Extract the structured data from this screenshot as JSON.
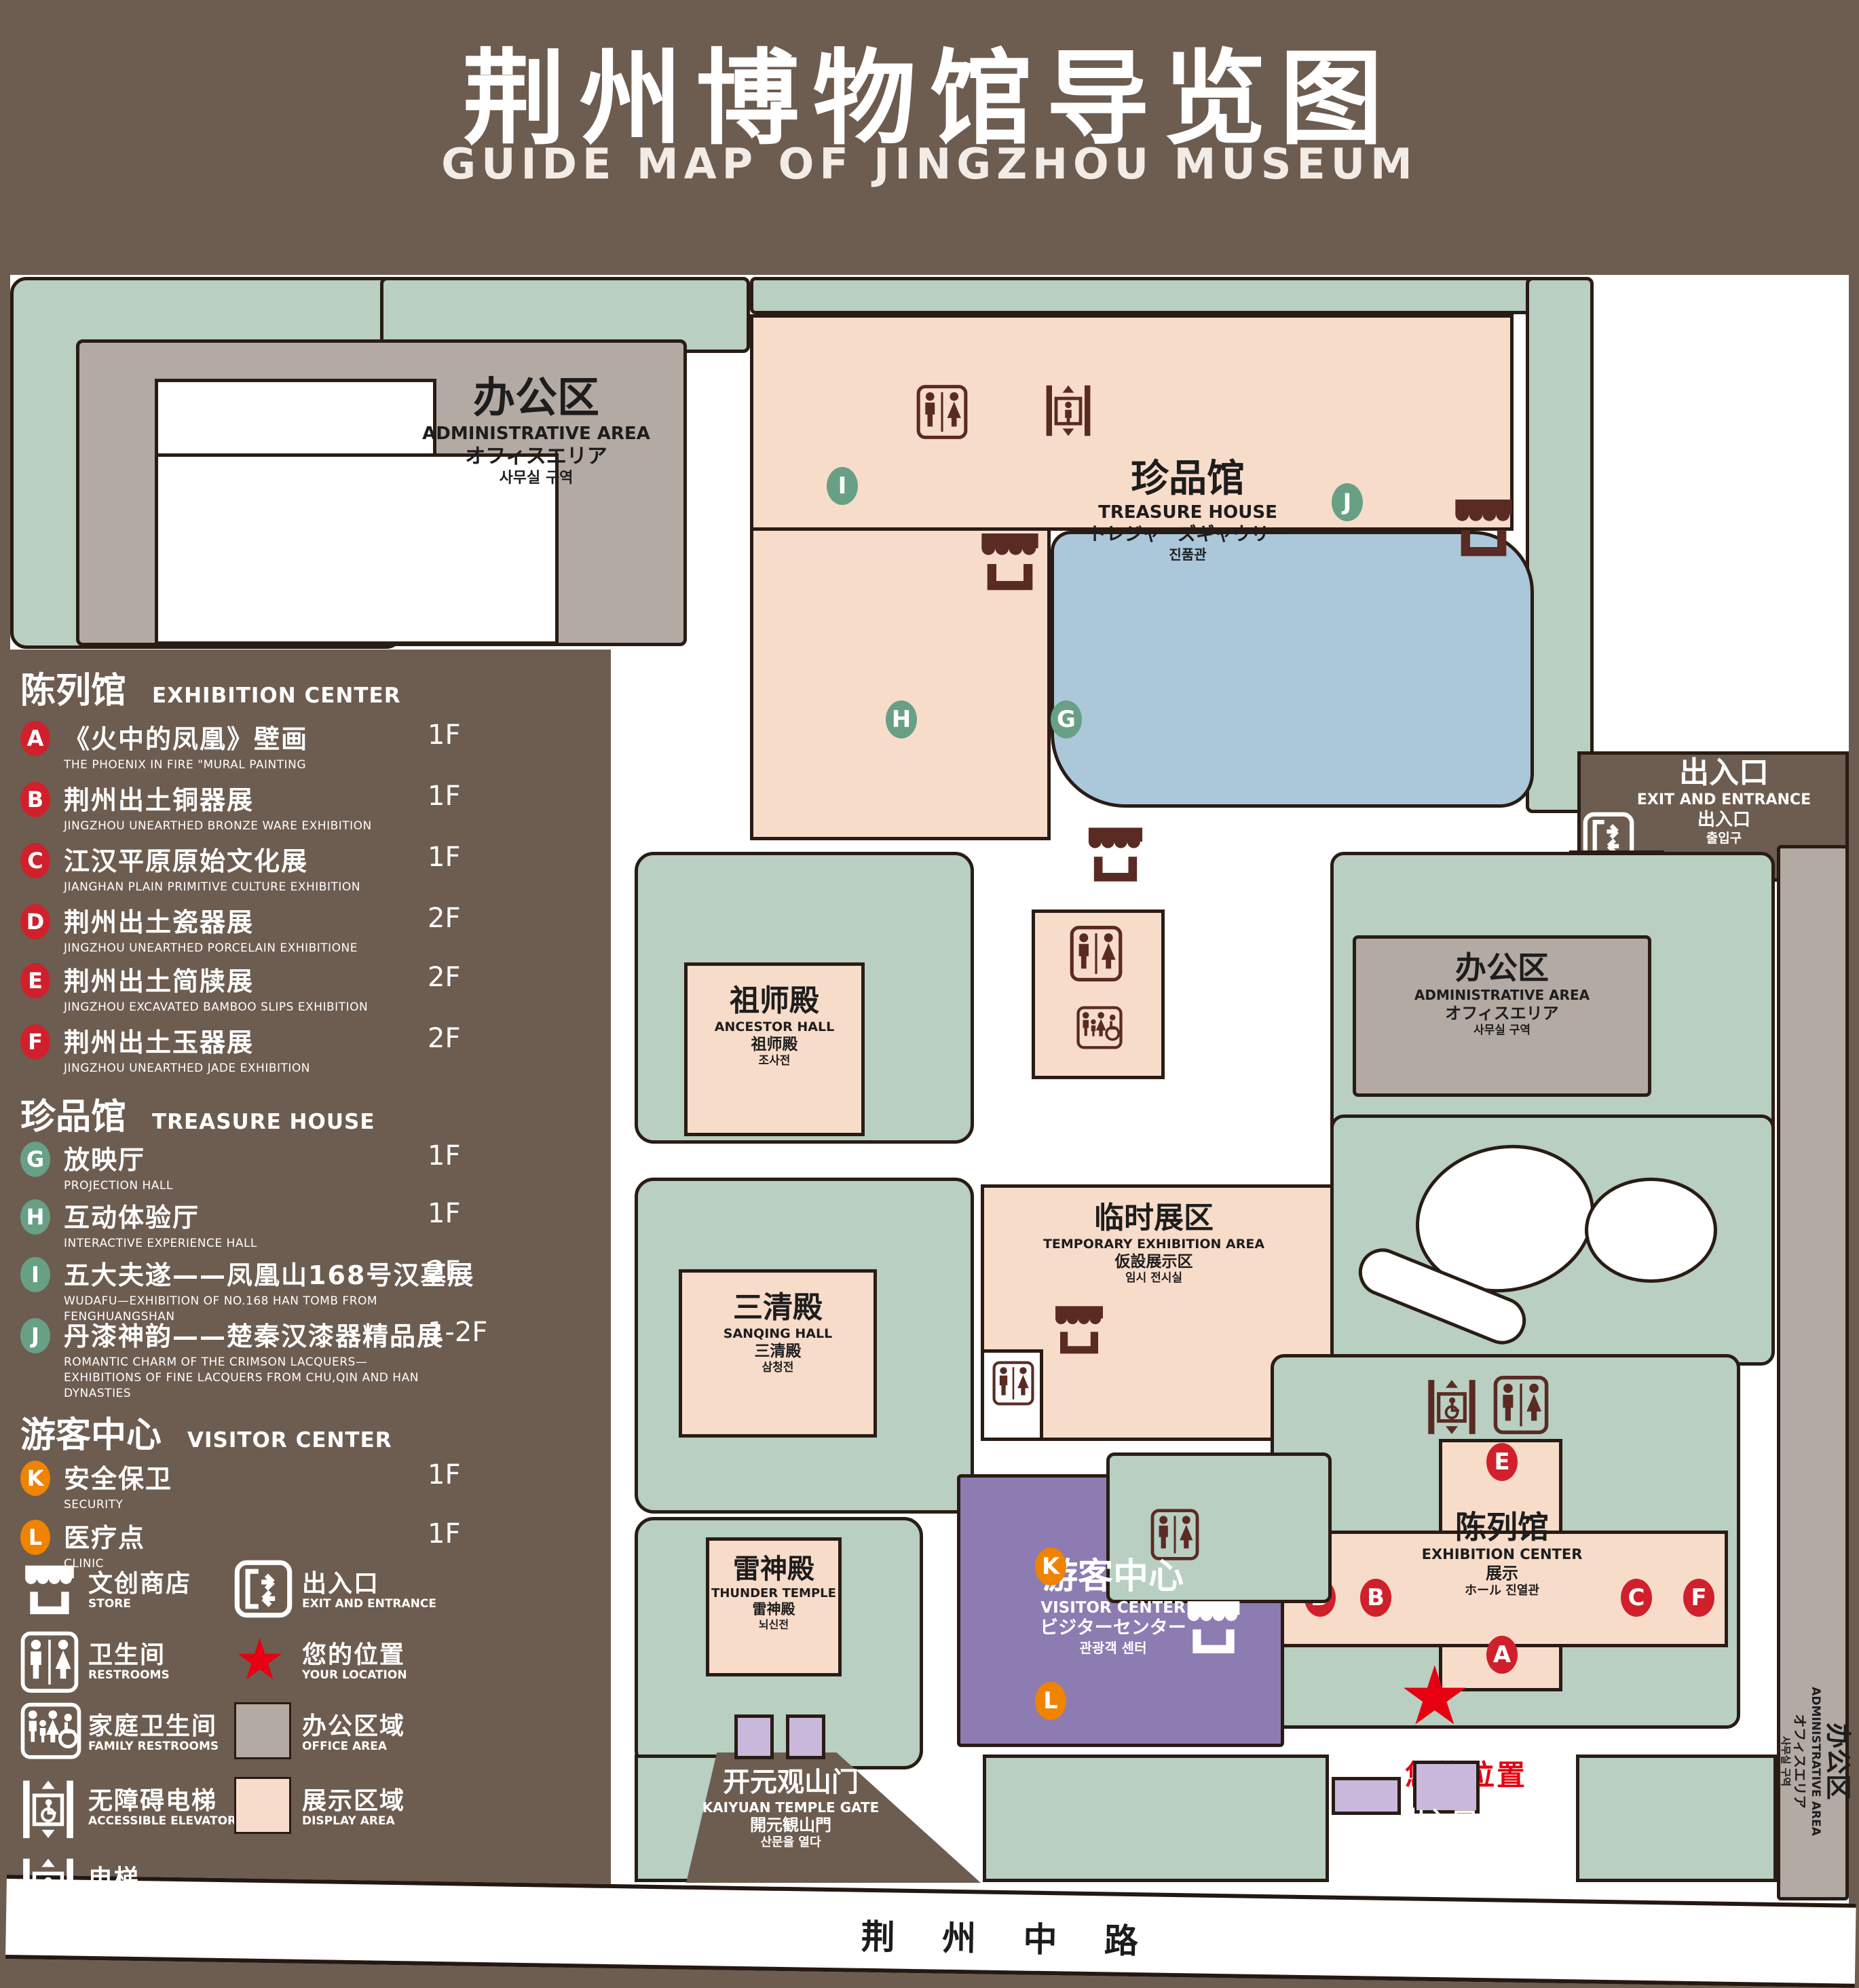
{
  "header": {
    "title": "荆州博物馆导览图",
    "subtitle": "GUIDE MAP OF JINGZHOU MUSEUM"
  },
  "legend": {
    "sections": [
      {
        "title_cn": "陈列馆",
        "title_en": "EXHIBITION CENTER",
        "items": [
          {
            "key": "A",
            "cn": "《火中的凤凰》壁画",
            "en": "THE PHOENIX IN FIRE \"MURAL PAINTING",
            "floor": "1F"
          },
          {
            "key": "B",
            "cn": "荆州出土铜器展",
            "en": "JINGZHOU UNEARTHED BRONZE WARE EXHIBITION",
            "floor": "1F"
          },
          {
            "key": "C",
            "cn": "江汉平原原始文化展",
            "en": "JIANGHAN PLAIN PRIMITIVE CULTURE EXHIBITION",
            "floor": "1F"
          },
          {
            "key": "D",
            "cn": "荆州出土瓷器展",
            "en": "JINGZHOU UNEARTHED PORCELAIN EXHIBITIONE",
            "floor": "2F"
          },
          {
            "key": "E",
            "cn": "荆州出土简牍展",
            "en": "JINGZHOU EXCAVATED BAMBOO SLIPS EXHIBITION",
            "floor": "2F"
          },
          {
            "key": "F",
            "cn": "荆州出土玉器展",
            "en": "JINGZHOU UNEARTHED JADE EXHIBITION",
            "floor": "2F"
          }
        ]
      },
      {
        "title_cn": "珍品馆",
        "title_en": "TREASURE HOUSE",
        "items": [
          {
            "key": "G",
            "cn": "放映厅",
            "en": "PROJECTION HALL",
            "floor": "1F"
          },
          {
            "key": "H",
            "cn": "互动体验厅",
            "en": "INTERACTIVE EXPERIENCE HALL",
            "floor": "1F"
          },
          {
            "key": "I",
            "cn": "五大夫遂——凤凰山168号汉墓展",
            "en": "WUDAFU—EXHIBITION OF NO.168 HAN TOMB FROM FENGHUANGSHAN",
            "floor": "2F"
          },
          {
            "key": "J",
            "cn": "丹漆神韵——楚秦汉漆器精品展",
            "en": "ROMANTIC CHARM OF THE CRIMSON LACQUERS—EXHIBITIONS OF FINE LACQUERS FROM CHU,QIN AND HAN DYNASTIES",
            "floor": "1-2F"
          }
        ]
      },
      {
        "title_cn": "游客中心",
        "title_en": "VISITOR CENTER",
        "items": [
          {
            "key": "K",
            "cn": "安全保卫",
            "en": "SECURITY",
            "floor": "1F"
          },
          {
            "key": "L",
            "cn": "医疗点",
            "en": "CLINIC",
            "floor": "1F"
          }
        ]
      }
    ],
    "icon_items": [
      {
        "icon": "store-icon",
        "cn": "文创商店",
        "en": "STORE"
      },
      {
        "icon": "exit-icon",
        "cn": "出入口",
        "en": "EXIT AND ENTRANCE"
      },
      {
        "icon": "restroom-icon",
        "cn": "卫生间",
        "en": "RESTROOMS"
      },
      {
        "icon": "location-star-icon",
        "cn": "您的位置",
        "en": "YOUR LOCATION"
      },
      {
        "icon": "family-restroom-icon",
        "cn": "家庭卫生间",
        "en": "FAMILY RESTROOMS"
      },
      {
        "icon": "office-area-swatch",
        "cn": "办公区域",
        "en": "OFFICE AREA"
      },
      {
        "icon": "accessible-elevator-icon",
        "cn": "无障碍电梯",
        "en": "ACCESSIBLE ELEVATOR"
      },
      {
        "icon": "display-area-swatch",
        "cn": "展示区域",
        "en": "DISPLAY AREA"
      },
      {
        "icon": "elevator-icon",
        "cn": "电梯",
        "en": "Elevator"
      }
    ]
  },
  "map": {
    "admin_nw": {
      "cn": "办公区",
      "en": "ADMINISTRATIVE AREA",
      "jp": "オフィスエリア",
      "kr": "사무실 구역"
    },
    "treasure_house": {
      "cn": "珍品馆",
      "en": "TREASURE HOUSE",
      "jp": "トレジャーズギャウリー",
      "kr": "진품관"
    },
    "ancestor_hall": {
      "cn": "祖师殿",
      "en": "ANCESTOR HALL",
      "jp": "祖师殿",
      "kr": "조사전"
    },
    "temporary_area": {
      "cn": "临时展区",
      "en": "TEMPORARY EXHIBITION AREA",
      "jp": "仮設展示区",
      "kr": "임시 전시실"
    },
    "admin_e": {
      "cn": "办公区",
      "en": "ADMINISTRATIVE AREA",
      "jp": "オフィスエリア",
      "kr": "사무실 구역"
    },
    "admin_strip": {
      "cn": "办公区",
      "en": "ADMINISTRATIVE AREA",
      "jp": "オフィスエリア",
      "kr": "사무실 구역"
    },
    "sanqing_hall": {
      "cn": "三清殿",
      "en": "SANQING HALL",
      "jp": "三清殿",
      "kr": "삼청전"
    },
    "thunder_temple": {
      "cn": "雷神殿",
      "en": "THUNDER TEMPLE",
      "jp": "雷神殿",
      "kr": "뇌신전"
    },
    "visitor_center": {
      "cn": "游客中心",
      "en": "VISITOR CENTER",
      "jp": "ビジターセンター",
      "kr": "관광객 센터"
    },
    "exhibition_center": {
      "cn": "陈列馆",
      "en": "EXHIBITION CENTER",
      "jp": "展示",
      "kr": "ホール 진열관"
    },
    "kaiyuan_gate": {
      "cn": "开元观山门",
      "en": "KAIYUAN TEMPLE GATE",
      "jp": "開元観山門",
      "kr": "산문을 열다"
    },
    "exit_ne": {
      "cn": "出入口",
      "en": "EXIT AND ENTRANCE",
      "jp": "出入口",
      "kr": "출입구"
    },
    "exit_s": {
      "cn": "出入口",
      "en": "EXIT AND ENTRANCE",
      "jp": "出入口",
      "kr": "출입구"
    },
    "road": "荆 州 中 路",
    "your_location": "您的位置",
    "badges": {
      "A": "A",
      "B": "B",
      "C": "C",
      "D": "D",
      "E": "E",
      "F": "F",
      "G": "G",
      "H": "H",
      "I": "I",
      "J": "J",
      "K": "K",
      "L": "L"
    }
  },
  "colors": {
    "background": "#6d5c50",
    "lawn": "#b8cfc2",
    "display_area": "#f8dcca",
    "office_area": "#b3aaa4",
    "pond": "#abc7da",
    "visitor_center": "#8d7cb2",
    "gate_building": "#cab8dc",
    "badge_red": "#d0202c",
    "badge_green": "#68a086",
    "badge_orange": "#f08300",
    "icon_maroon": "#5a2b23",
    "location_red": "#e60012"
  }
}
